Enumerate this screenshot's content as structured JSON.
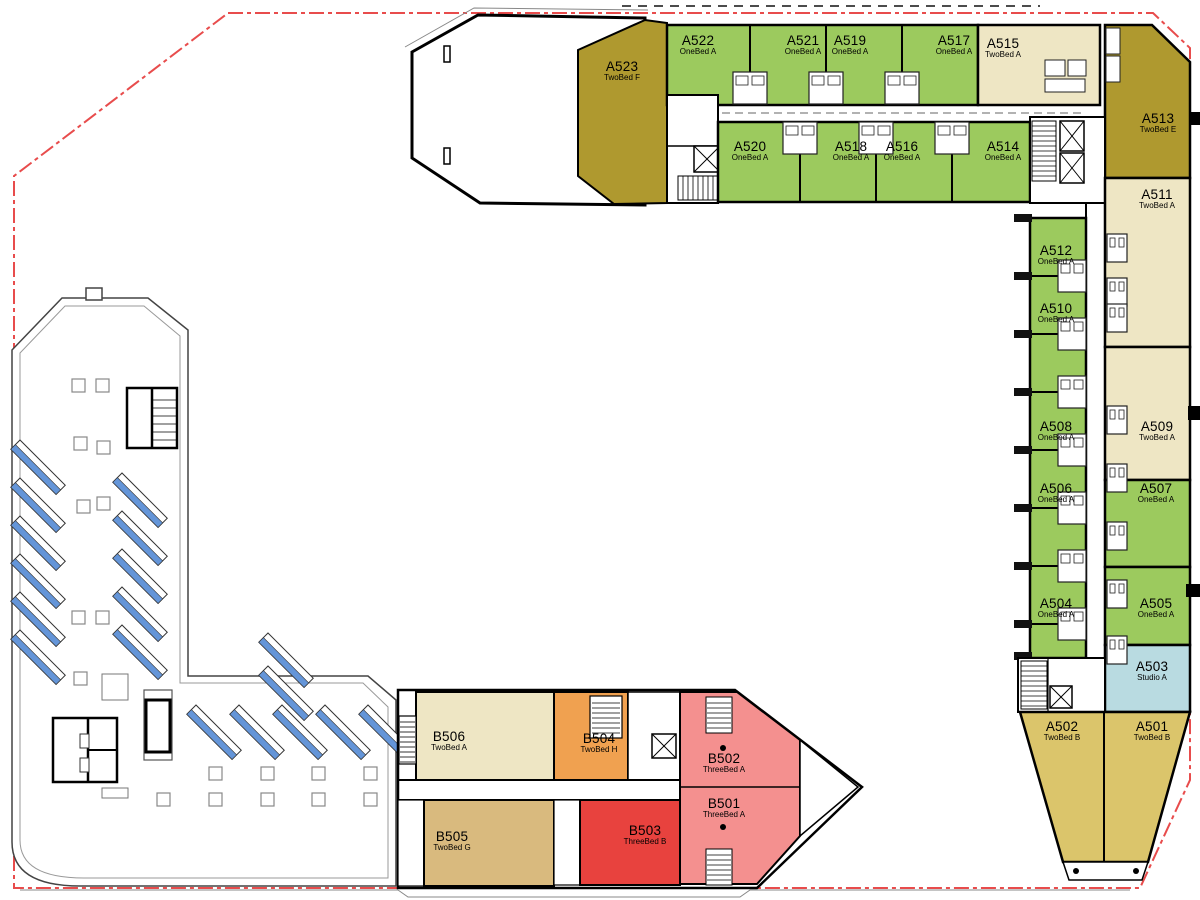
{
  "plan": {
    "building_wings": [
      "A",
      "B"
    ],
    "areas": [
      "parking-terrace",
      "top-wing",
      "right-wing",
      "bottom-wing"
    ]
  },
  "units": [
    {
      "id": "A523",
      "type": "TwoBed F"
    },
    {
      "id": "A522",
      "type": "OneBed A"
    },
    {
      "id": "A521",
      "type": "OneBed A"
    },
    {
      "id": "A519",
      "type": "OneBed A"
    },
    {
      "id": "A517",
      "type": "OneBed A"
    },
    {
      "id": "A515",
      "type": "TwoBed A"
    },
    {
      "id": "A513",
      "type": "TwoBed E"
    },
    {
      "id": "A520",
      "type": "OneBed A"
    },
    {
      "id": "A518",
      "type": "OneBed A"
    },
    {
      "id": "A516",
      "type": "OneBed A"
    },
    {
      "id": "A514",
      "type": "OneBed A"
    },
    {
      "id": "A511",
      "type": "TwoBed A"
    },
    {
      "id": "A512",
      "type": "OneBed A"
    },
    {
      "id": "A510",
      "type": "OneBed A"
    },
    {
      "id": "A508",
      "type": "OneBed A"
    },
    {
      "id": "A509",
      "type": "TwoBed A"
    },
    {
      "id": "A506",
      "type": "OneBed A"
    },
    {
      "id": "A507",
      "type": "OneBed A"
    },
    {
      "id": "A504",
      "type": "OneBed A"
    },
    {
      "id": "A505",
      "type": "OneBed A"
    },
    {
      "id": "A503",
      "type": "Studio A"
    },
    {
      "id": "A502",
      "type": "TwoBed B"
    },
    {
      "id": "A501",
      "type": "TwoBed B"
    },
    {
      "id": "B506",
      "type": "TwoBed A"
    },
    {
      "id": "B504",
      "type": "TwoBed H"
    },
    {
      "id": "B502",
      "type": "ThreeBed A"
    },
    {
      "id": "B501",
      "type": "ThreeBed A"
    },
    {
      "id": "B505",
      "type": "TwoBed G"
    },
    {
      "id": "B503",
      "type": "ThreeBed B"
    }
  ],
  "colors": {
    "onebed_a": "#9cca5e",
    "twobed_a": "#eee6c4",
    "twobed_e": "#af992f",
    "twobed_f": "#af992f",
    "twobed_b": "#dbc56b",
    "twobed_g": "#d9ba7e",
    "twobed_h": "#f0a150",
    "threebed_a": "#f4908f",
    "threebed_b": "#e8423e",
    "studio_a": "#b9dbe1",
    "solar_panel": "#6495d8",
    "site_boundary": "#e84c4c",
    "wall": "#000000"
  }
}
